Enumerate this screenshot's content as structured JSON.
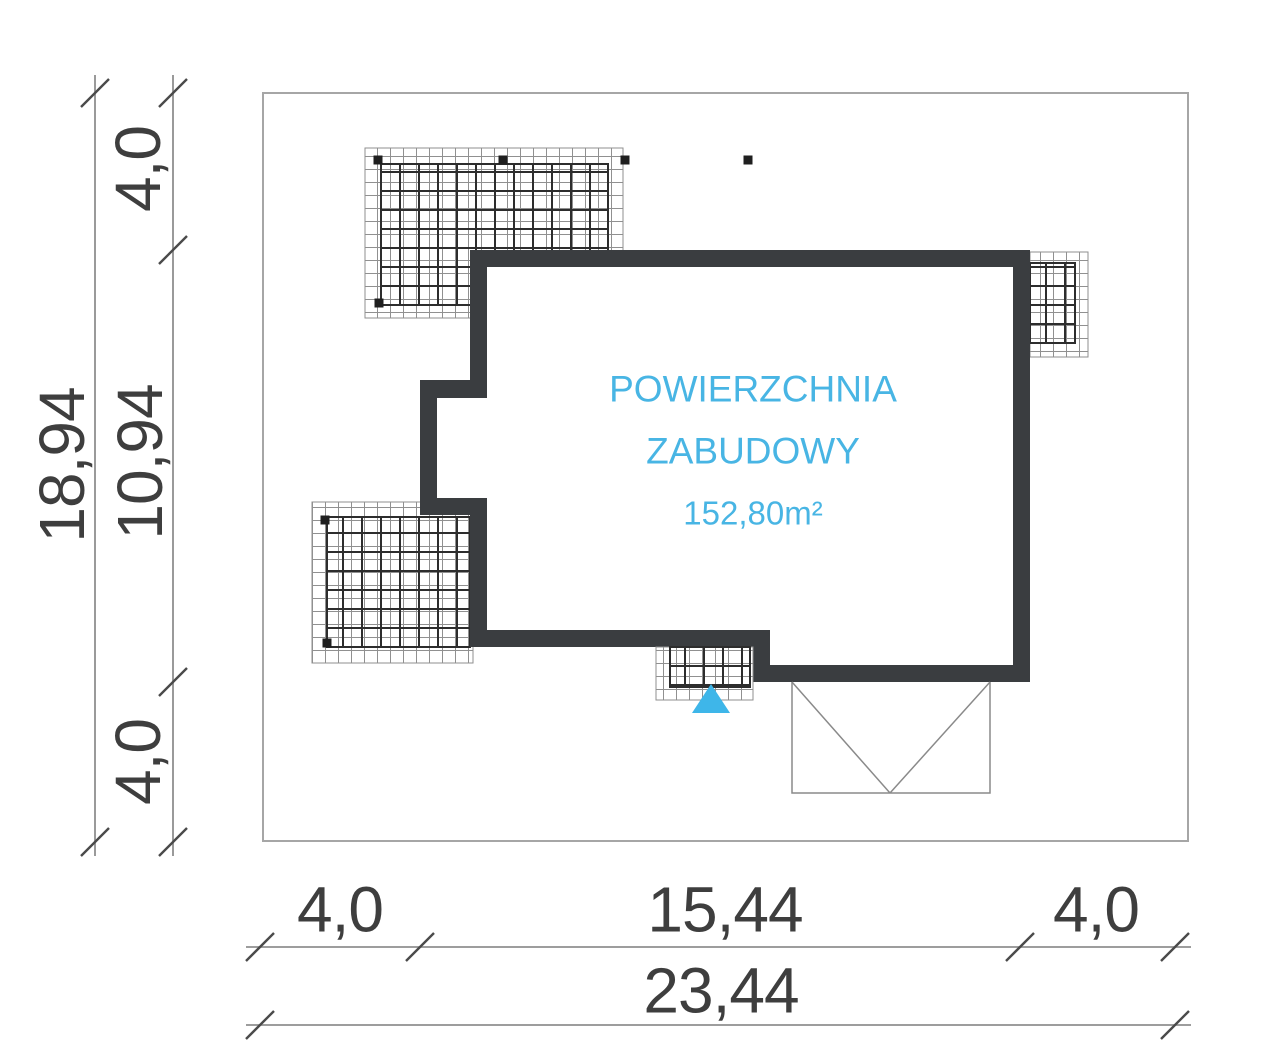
{
  "drawing": {
    "area_label": {
      "line1": "POWIERZCHNIA",
      "line2": "ZABUDOWY",
      "value": "152,80m²"
    },
    "dimensions": {
      "left_margin_top": "4,0",
      "left_total": "18,94",
      "left_building": "10,94",
      "left_margin_bottom": "4,0",
      "bottom_margin_left": "4,0",
      "bottom_building": "15,44",
      "bottom_margin_right": "4,0",
      "bottom_total": "23,44"
    },
    "colors": {
      "accent_cyan": "#48b5e4",
      "entrance_marker": "#3eb6e9",
      "wall": "#3a3d40",
      "dimension_text": "#3e3e3e",
      "plot_boundary": "#a6a6a6"
    }
  }
}
